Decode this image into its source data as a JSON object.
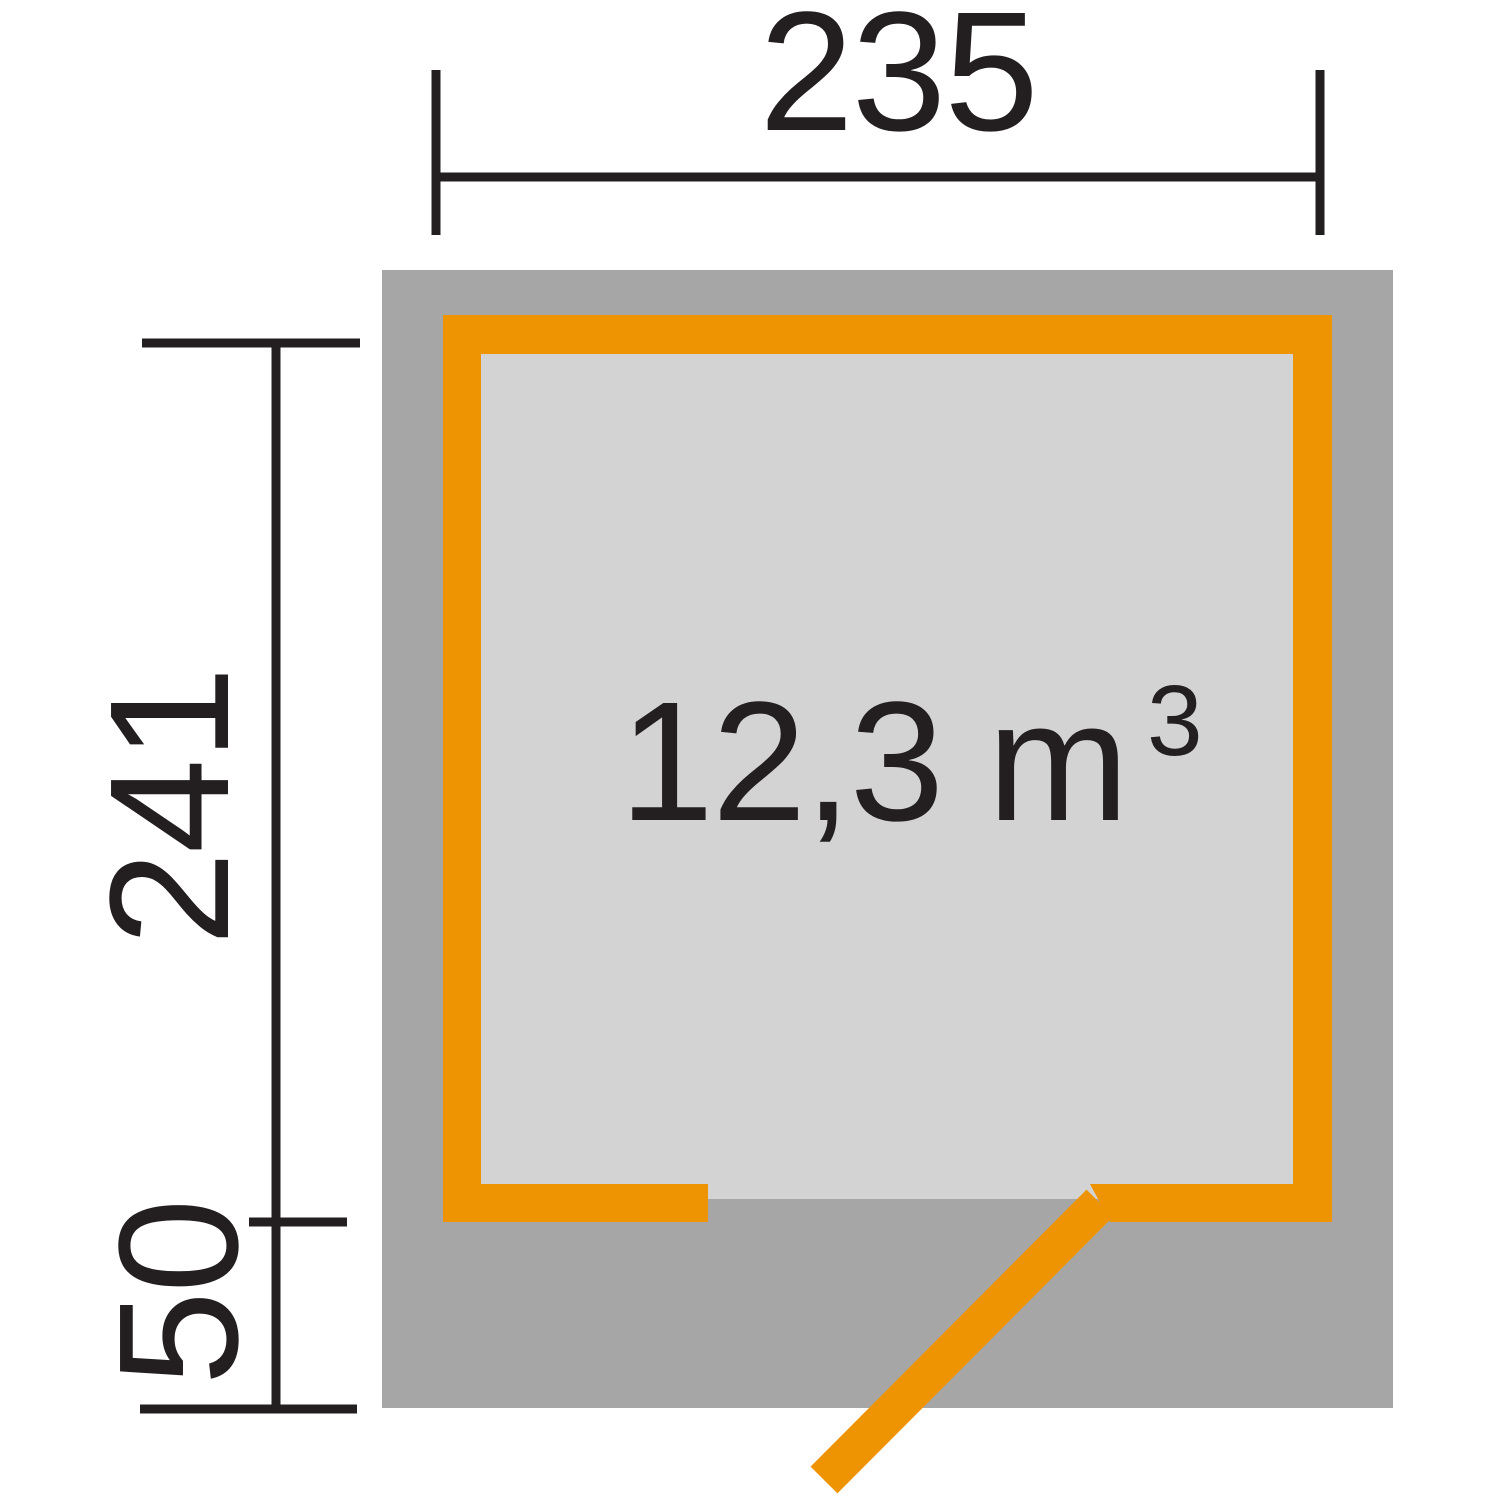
{
  "diagram": {
    "type": "floor-plan",
    "description": "Garden shed floor plan top view with outer roof overhang, orange wall outline, door opening with swing leaf, and dimension lines",
    "width_dimension": {
      "label": "235"
    },
    "height_dimension": {
      "label": "241"
    },
    "offset_dimension": {
      "label": "50"
    },
    "volume": {
      "text": "12,3 m",
      "superscript": "3"
    },
    "colors": {
      "wall": "#EE9402",
      "roof_overhang": "#A6A6A6",
      "floor": "#D3D3D3",
      "dimension": "#231F20",
      "background": "#FFFFFF"
    }
  }
}
